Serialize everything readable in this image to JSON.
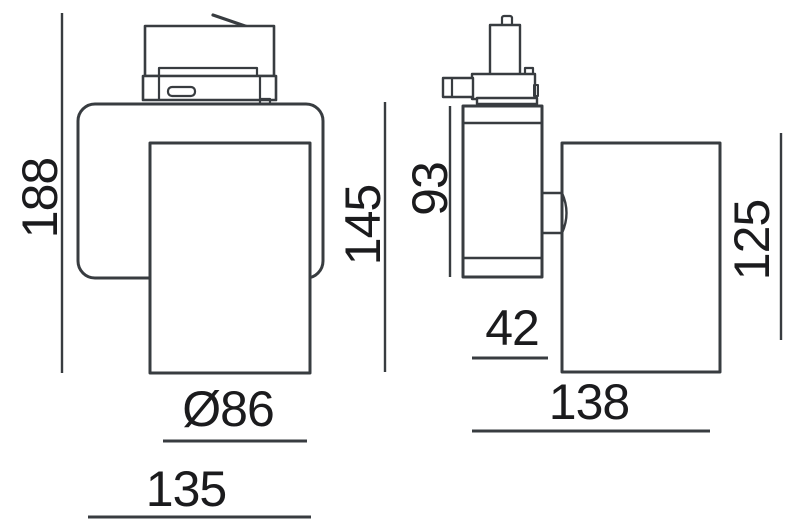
{
  "drawing": {
    "line_color": "#383c40",
    "text_color": "#1b1b1d",
    "background_color": "#ffffff",
    "dimensions": {
      "front": {
        "overall_height": "188",
        "head_height": "145",
        "head_diameter": "Ø86",
        "body_width": "135"
      },
      "side": {
        "adapter_body_height": "93",
        "body_depth": "42",
        "head_height": "125",
        "head_length": "138"
      }
    }
  }
}
